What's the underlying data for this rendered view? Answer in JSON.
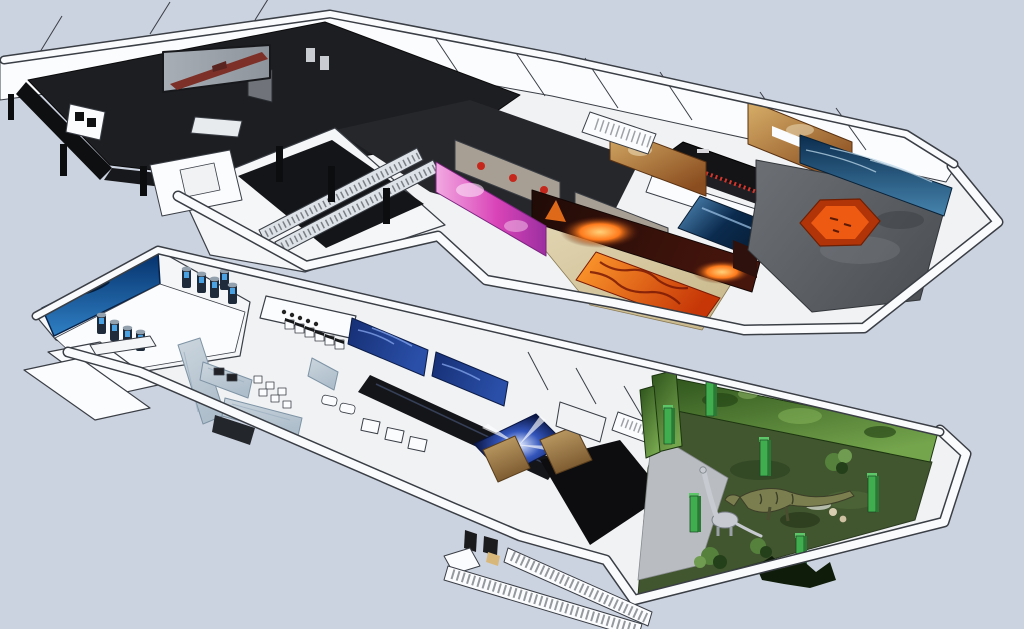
{
  "scene": {
    "description": "isometric-3d-museum-floorplan-rendering",
    "floors": [
      {
        "name": "upper-exhibition-floor",
        "features": [
          "back-gallery-rooms",
          "dark-theater-wing",
          "projection-screen",
          "display-case",
          "escalator-hall",
          "escalators",
          "pink-media-wall",
          "poster-corridor",
          "volcano-exhibit-room",
          "lava-floor-strip",
          "exhibit-counter",
          "water-channel",
          "rust-textured-walls",
          "hexagon-platform-room",
          "ocean-wave-mural",
          "back-staircase"
        ]
      },
      {
        "name": "lower-exhibition-floor",
        "features": [
          "aquarium-mural-room",
          "display-pedestals",
          "entry-ramps",
          "cafe-seating-area",
          "ice-textured-walls",
          "kiosk-counters",
          "undersea-mural-corridor",
          "dark-corridor",
          "vortex-tunnel-floor",
          "rock-cave-walls",
          "jungle-dinosaur-room",
          "green-pillars",
          "trex-model",
          "sauropod-model",
          "exterior-staircase"
        ]
      }
    ]
  },
  "colors": {
    "bg": "#ccd3e0",
    "line": "#3a3e45",
    "wallFill": "#f4f6f8",
    "wallLight": "#fbfcfe",
    "floorWhite": "#f0f2f4",
    "blackFloor": "#1d1e21",
    "blackWall": "#0e0f11",
    "grayWall": "#70747a",
    "screenGray": "#a8aeb6",
    "shipRed": "#7c3028",
    "pinkLight": "#f2a9e2",
    "pinkMid": "#d944b8",
    "pinkDeep": "#9c2fa0",
    "posterWall": "#a79f93",
    "posterRed": "#c5271c",
    "sandLight": "#e3d7b4",
    "sandDark": "#c9b88c",
    "volcanoDark": "#200b07",
    "volcanoMid": "#46150c",
    "glowOrange": "#ff7b1c",
    "glowYellow": "#ffd27a",
    "lavaBright": "#ff9d2e",
    "lavaDeep": "#c63607",
    "lavaCrack": "#7a1a06",
    "counterBlack": "#141417",
    "itemRed": "#d5352a",
    "channelTop": "#0b2b4e",
    "channelLight": "#5590c0",
    "rustLight": "#d8b06a",
    "rustDeep": "#8a4d1f",
    "stoneDark": "#4e5256",
    "stoneLight": "#6d7176",
    "hexTop": "#ef5a12",
    "hexSide": "#b03408",
    "oceanDeep": "#0b2d4e",
    "oceanLight": "#4684ae",
    "aquaDeep": "#05306b",
    "aquaLight": "#2f80c4",
    "silhouette": "#041e3d",
    "pedBody": "#1f2b3a",
    "pedTop": "#93a0ae",
    "pedScreen": "#4aa2e2",
    "iceWall": "#ccd6de",
    "iceVein": "#9fb2c0",
    "muralBlue": "#162f74",
    "muralStreak": "#7fa0e8",
    "corridorBlack": "#141519",
    "vortexDeep": "#0a1540",
    "vortexLight": "#dfe9ff",
    "rockLight": "#c9a86e",
    "rockDeep": "#7c5a30",
    "jungleDark": "#2e531c",
    "jungleLight": "#74a44c",
    "jungleFloor": "#41552f",
    "concrete": "#b9bdc1",
    "pillarGreen": "#3fae4f",
    "pillarDark": "#2a7a36",
    "dinoGreen": "#7b7f4f",
    "dinoGray": "#c7cbd1",
    "bushGreen": "#55813c",
    "bushDark": "#24401a"
  }
}
